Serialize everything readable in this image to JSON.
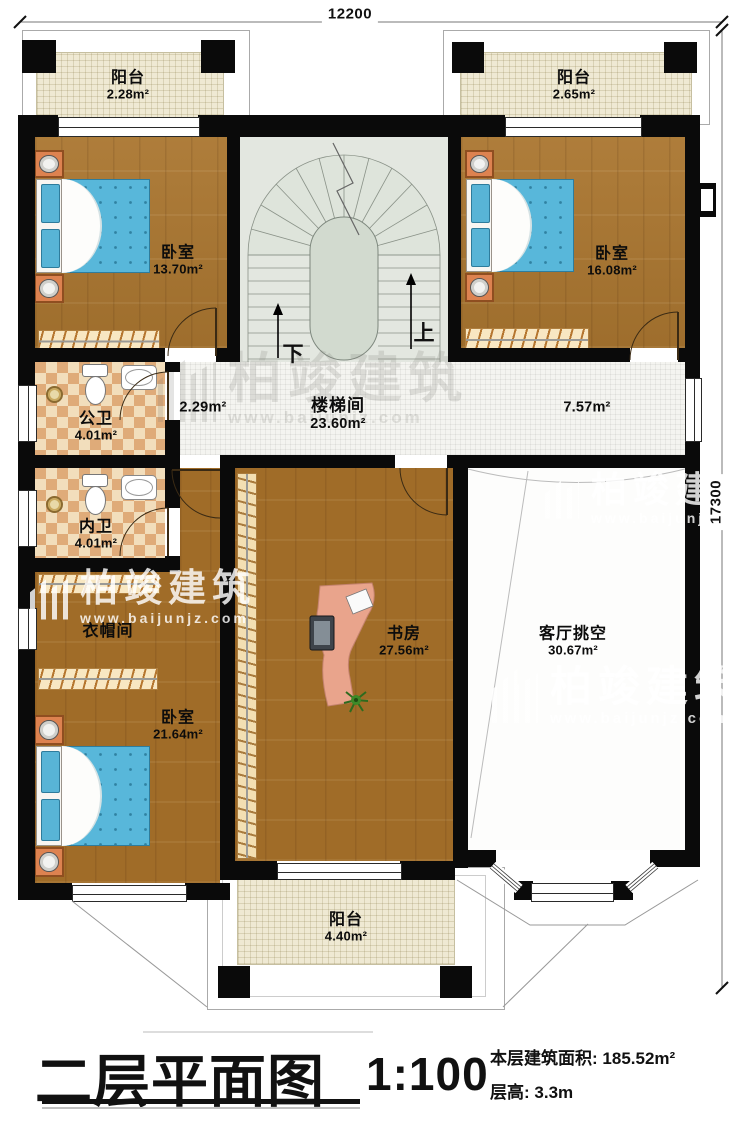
{
  "watermark": {
    "brand": "柏竣建筑",
    "url": "www.baijunjz.com"
  },
  "dimensions": {
    "width": "12200",
    "height": "17300"
  },
  "stairs": {
    "up_label": "上",
    "down_label": "下"
  },
  "rooms": {
    "balcony_tl": {
      "name": "阳台",
      "area": "2.28m²"
    },
    "balcony_tr": {
      "name": "阳台",
      "area": "2.65m²"
    },
    "bedroom_tl": {
      "name": "卧室",
      "area": "13.70m²"
    },
    "bedroom_tr": {
      "name": "卧室",
      "area": "16.08m²"
    },
    "stairwell": {
      "name": "楼梯间",
      "area": "23.60m²"
    },
    "hall_left": {
      "area": "2.29m²"
    },
    "hall_right": {
      "area": "7.57m²"
    },
    "bath_public": {
      "name": "公卫",
      "area": "4.01m²"
    },
    "bath_private": {
      "name": "内卫",
      "area": "4.01m²"
    },
    "cloakroom": {
      "name": "衣帽间"
    },
    "bedroom_bl": {
      "name": "卧室",
      "area": "21.64m²"
    },
    "study": {
      "name": "书房",
      "area": "27.56m²"
    },
    "living_void": {
      "name": "客厅挑空",
      "area": "30.67m²"
    },
    "balcony_bottom": {
      "name": "阳台",
      "area": "4.40m²"
    }
  },
  "titleblock": {
    "plan_title": "二层平面图",
    "scale": "1:100",
    "area_label": "本层建筑面积:",
    "area_value": "185.52m²",
    "height_label": "层高:",
    "height_value": "3.3m"
  }
}
